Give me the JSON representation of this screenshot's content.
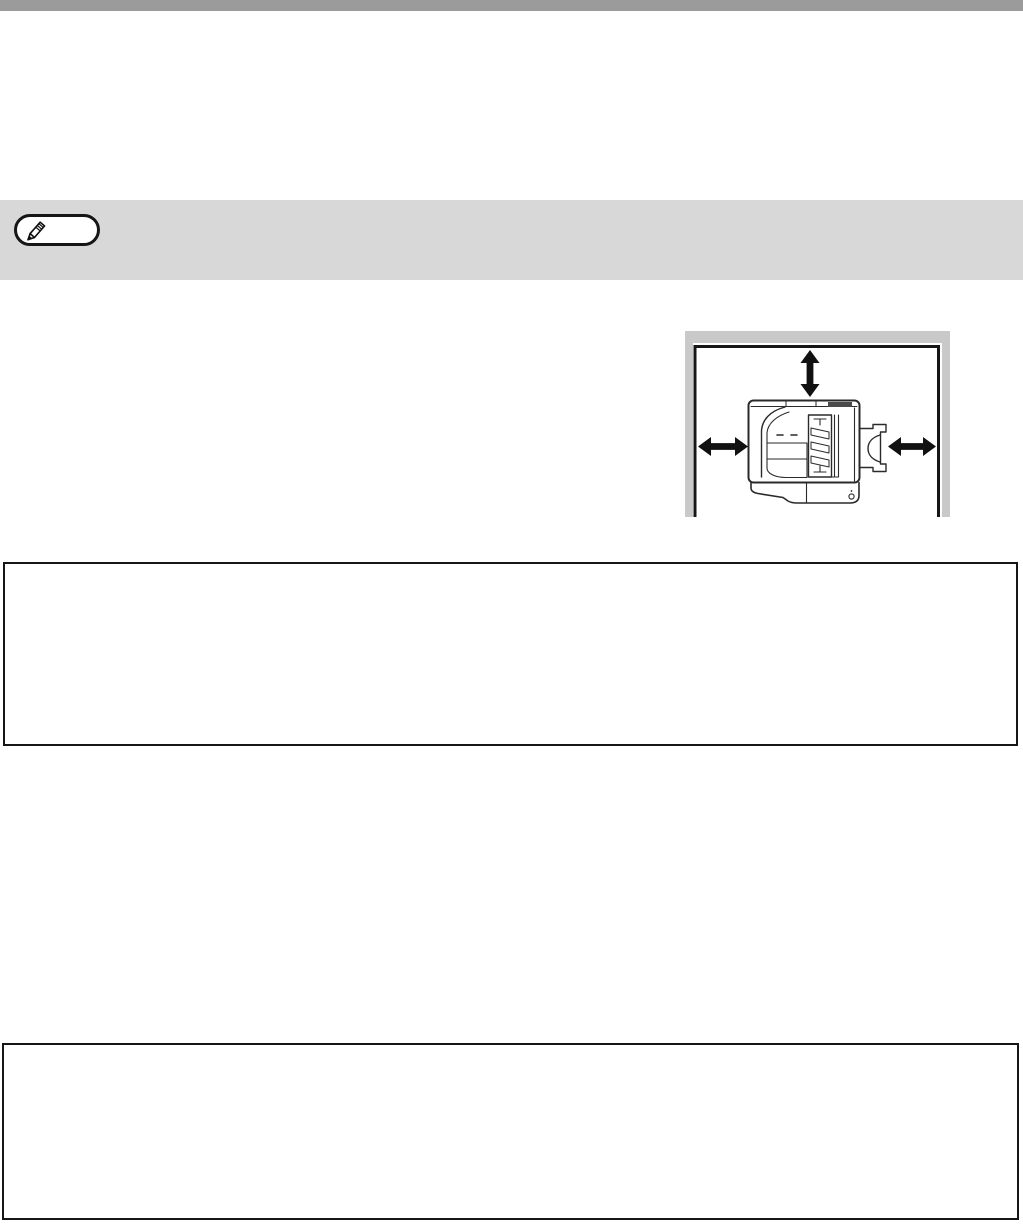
{
  "document": {
    "kind": "printer-manual-page"
  },
  "colors": {
    "page-bg": "#ffffff",
    "top-bar": "#9b9b9b",
    "note-band": "#d8d8d8",
    "pill-border": "#161616",
    "illus-wall": "#c9c9c9",
    "line": "#161616",
    "art-line": "#2a2a2a",
    "arrow": "#111111",
    "dark-bar": "#4a4a4a"
  },
  "note": {
    "icon": "pencil-icon"
  },
  "illustration": {
    "name": "copier-clearance-top-view",
    "arrows": [
      "double-arrow-vertical",
      "double-arrow-horizontal-left",
      "double-arrow-horizontal-right"
    ]
  },
  "callout_boxes": {
    "count": 2
  }
}
